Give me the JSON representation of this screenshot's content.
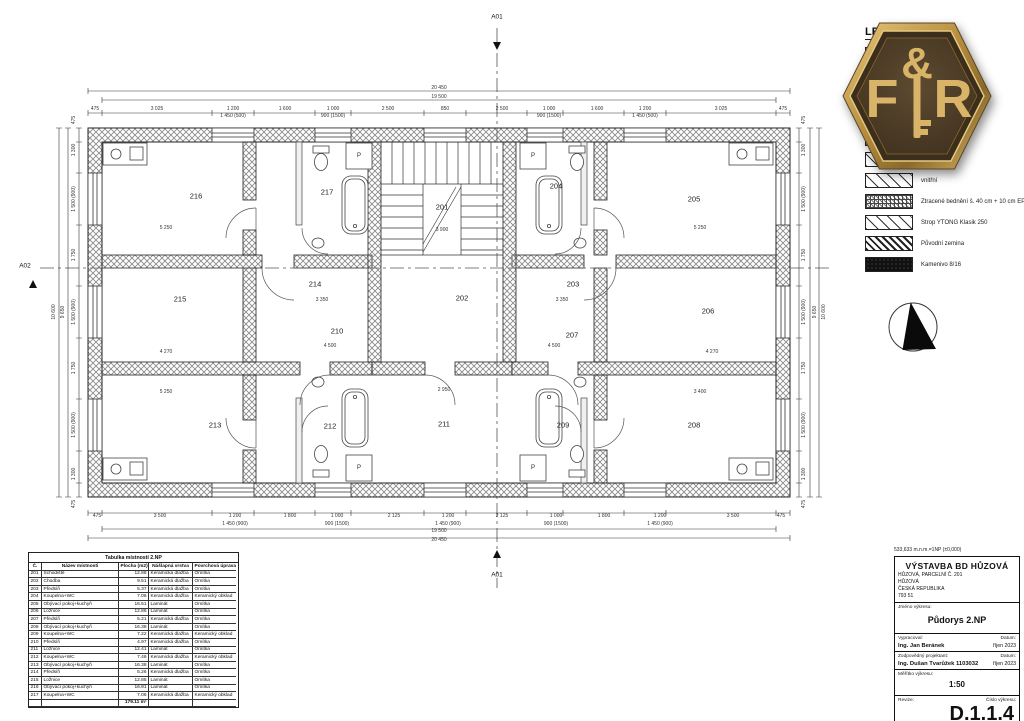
{
  "markers": {
    "a01_top": "A01",
    "a01_bottom": "A01",
    "a02": "A02"
  },
  "legend": {
    "title": "LEGENDA",
    "rows": [
      {
        "swatch": "checker",
        "label": "375 + 10 cm EPS"
      },
      {
        "swatch": "checker",
        "label": ""
      },
      {
        "swatch": "checker",
        "label": ""
      },
      {
        "swatch": "checker",
        "label": ""
      },
      {
        "swatch": "checker",
        "label": ""
      },
      {
        "swatch": "hatch-sparse",
        "label": ""
      },
      {
        "swatch": "hatch-sparse",
        "label": "vnitřní"
      },
      {
        "swatch": "grid",
        "label": "Ztracené bednění š. 40 cm + 10 cm EPS"
      },
      {
        "swatch": "hatch-sparse",
        "label": "Strop YTONG Klasik 250"
      },
      {
        "swatch": "hatch-dense",
        "label": "Původní zemina"
      },
      {
        "swatch": "dark",
        "label": "Kamenivo 8/16"
      }
    ]
  },
  "logo": {
    "left": "F",
    "amp": "&",
    "right": "R"
  },
  "plan": {
    "rooms": [
      {
        "n": "216",
        "x": 196,
        "y": 196
      },
      {
        "n": "217",
        "x": 327,
        "y": 192
      },
      {
        "n": "201",
        "x": 442,
        "y": 207
      },
      {
        "n": "204",
        "x": 556,
        "y": 186
      },
      {
        "n": "205",
        "x": 694,
        "y": 199
      },
      {
        "n": "215",
        "x": 180,
        "y": 299
      },
      {
        "n": "214",
        "x": 315,
        "y": 284
      },
      {
        "n": "202",
        "x": 462,
        "y": 298
      },
      {
        "n": "203",
        "x": 573,
        "y": 284
      },
      {
        "n": "206",
        "x": 708,
        "y": 311
      },
      {
        "n": "210",
        "x": 337,
        "y": 331
      },
      {
        "n": "207",
        "x": 572,
        "y": 335
      },
      {
        "n": "213",
        "x": 215,
        "y": 425
      },
      {
        "n": "212",
        "x": 330,
        "y": 426
      },
      {
        "n": "211",
        "x": 444,
        "y": 424
      },
      {
        "n": "209",
        "x": 563,
        "y": 425
      },
      {
        "n": "208",
        "x": 694,
        "y": 425
      }
    ],
    "fixture_labels": [
      {
        "t": "P",
        "x": 359,
        "y": 156
      },
      {
        "t": "P",
        "x": 533,
        "y": 156
      },
      {
        "t": "P",
        "x": 359,
        "y": 468
      },
      {
        "t": "P",
        "x": 533,
        "y": 468
      }
    ],
    "dims": [
      {
        "t": "20 450",
        "x": 439,
        "y": 88
      },
      {
        "t": "19 500",
        "x": 439,
        "y": 97
      },
      {
        "t": "475",
        "x": 95,
        "y": 109
      },
      {
        "t": "3 025",
        "x": 157,
        "y": 109
      },
      {
        "t": "1 200",
        "x": 233,
        "y": 109
      },
      {
        "t": "1 450 (500)",
        "x": 233,
        "y": 116
      },
      {
        "t": "1 600",
        "x": 285,
        "y": 109
      },
      {
        "t": "1 000",
        "x": 333,
        "y": 109
      },
      {
        "t": "900 (1500)",
        "x": 333,
        "y": 116
      },
      {
        "t": "2 500",
        "x": 388,
        "y": 109
      },
      {
        "t": "850",
        "x": 445,
        "y": 109
      },
      {
        "t": "2 500",
        "x": 502,
        "y": 109
      },
      {
        "t": "1 000",
        "x": 549,
        "y": 109
      },
      {
        "t": "900 (1500)",
        "x": 549,
        "y": 116
      },
      {
        "t": "1 600",
        "x": 597,
        "y": 109
      },
      {
        "t": "1 200",
        "x": 645,
        "y": 109
      },
      {
        "t": "1 450 (500)",
        "x": 645,
        "y": 116
      },
      {
        "t": "3 025",
        "x": 721,
        "y": 109
      },
      {
        "t": "475",
        "x": 783,
        "y": 109
      },
      {
        "t": "475",
        "x": 97,
        "y": 516
      },
      {
        "t": "3 500",
        "x": 160,
        "y": 516
      },
      {
        "t": "1 200",
        "x": 235,
        "y": 516
      },
      {
        "t": "1 450 (900)",
        "x": 235,
        "y": 524
      },
      {
        "t": "1 800",
        "x": 290,
        "y": 516
      },
      {
        "t": "1 000",
        "x": 337,
        "y": 516
      },
      {
        "t": "900 (1500)",
        "x": 337,
        "y": 524
      },
      {
        "t": "2 125",
        "x": 394,
        "y": 516
      },
      {
        "t": "1 200",
        "x": 448,
        "y": 516
      },
      {
        "t": "1 450 (900)",
        "x": 448,
        "y": 524
      },
      {
        "t": "2 125",
        "x": 502,
        "y": 516
      },
      {
        "t": "1 000",
        "x": 556,
        "y": 516
      },
      {
        "t": "900 (1500)",
        "x": 556,
        "y": 524
      },
      {
        "t": "1 800",
        "x": 604,
        "y": 516
      },
      {
        "t": "1 200",
        "x": 660,
        "y": 516
      },
      {
        "t": "1 450 (900)",
        "x": 660,
        "y": 524
      },
      {
        "t": "3 500",
        "x": 733,
        "y": 516
      },
      {
        "t": "475",
        "x": 781,
        "y": 516
      },
      {
        "t": "19 500",
        "x": 439,
        "y": 531
      },
      {
        "t": "20 450",
        "x": 439,
        "y": 540
      },
      {
        "t": "475",
        "x": 74,
        "y": 120,
        "c": "rot"
      },
      {
        "t": "1 300",
        "x": 74,
        "y": 150,
        "c": "rot"
      },
      {
        "t": "1 500 (900)",
        "x": 74,
        "y": 199,
        "c": "rot"
      },
      {
        "t": "1 750",
        "x": 74,
        "y": 255,
        "c": "rot"
      },
      {
        "t": "1 500 (900)",
        "x": 74,
        "y": 312,
        "c": "rot"
      },
      {
        "t": "1 750",
        "x": 74,
        "y": 368,
        "c": "rot"
      },
      {
        "t": "1 500 (900)",
        "x": 74,
        "y": 425,
        "c": "rot"
      },
      {
        "t": "1 300",
        "x": 74,
        "y": 474,
        "c": "rot"
      },
      {
        "t": "475",
        "x": 74,
        "y": 504,
        "c": "rot"
      },
      {
        "t": "9 650",
        "x": 63,
        "y": 312,
        "c": "rot"
      },
      {
        "t": "10 600",
        "x": 54,
        "y": 312,
        "c": "rot"
      },
      {
        "t": "475",
        "x": 804,
        "y": 120,
        "c": "rot"
      },
      {
        "t": "1 300",
        "x": 804,
        "y": 150,
        "c": "rot"
      },
      {
        "t": "1 500 (900)",
        "x": 804,
        "y": 199,
        "c": "rot"
      },
      {
        "t": "1 750",
        "x": 804,
        "y": 255,
        "c": "rot"
      },
      {
        "t": "1 500 (900)",
        "x": 804,
        "y": 312,
        "c": "rot"
      },
      {
        "t": "1 750",
        "x": 804,
        "y": 368,
        "c": "rot"
      },
      {
        "t": "1 500 (900)",
        "x": 804,
        "y": 425,
        "c": "rot"
      },
      {
        "t": "1 300",
        "x": 804,
        "y": 474,
        "c": "rot"
      },
      {
        "t": "475",
        "x": 804,
        "y": 504,
        "c": "rot"
      },
      {
        "t": "9 650",
        "x": 815,
        "y": 312,
        "c": "rot"
      },
      {
        "t": "10 600",
        "x": 824,
        "y": 312,
        "c": "rot"
      },
      {
        "t": "3 900",
        "x": 442,
        "y": 230
      },
      {
        "t": "3 350",
        "x": 322,
        "y": 300
      },
      {
        "t": "3 350",
        "x": 562,
        "y": 300
      },
      {
        "t": "4 500",
        "x": 330,
        "y": 346
      },
      {
        "t": "4 500",
        "x": 554,
        "y": 346
      },
      {
        "t": "2 950",
        "x": 444,
        "y": 390
      },
      {
        "t": "5 250",
        "x": 166,
        "y": 228
      },
      {
        "t": "5 250",
        "x": 700,
        "y": 228
      },
      {
        "t": "4 270",
        "x": 166,
        "y": 352
      },
      {
        "t": "4 270",
        "x": 712,
        "y": 352
      },
      {
        "t": "5 250",
        "x": 166,
        "y": 392
      },
      {
        "t": "3 400",
        "x": 700,
        "y": 392
      }
    ]
  },
  "room_table": {
    "title": "Tabulka místností 2.NP",
    "headers": [
      "Č.",
      "Název místnosti",
      "Plocha (m2)",
      "Nášlapná vrstva",
      "Povrchová úprava zdí"
    ],
    "rows": [
      {
        "c": "201",
        "n": "Schodiště",
        "p": "12.88",
        "v": "Keramická dlažba",
        "s": "Omítka"
      },
      {
        "c": "202",
        "n": "Chodba",
        "p": "9.51",
        "v": "Keramická dlažba",
        "s": "Omítka"
      },
      {
        "c": "203",
        "n": "Předsíň",
        "p": "5.37",
        "v": "Keramická dlažba",
        "s": "Omítka"
      },
      {
        "c": "204",
        "n": "Koupelna+WC",
        "p": "7.06",
        "v": "Keramická dlažba",
        "s": "Keramický obklad"
      },
      {
        "c": "205",
        "n": "Obývací pokoj+kuchyň",
        "p": "16.51",
        "v": "Laminát",
        "s": "Omítka"
      },
      {
        "c": "206",
        "n": "Ložnice",
        "p": "12.86",
        "v": "Laminát",
        "s": "Omítka"
      },
      {
        "c": "207",
        "n": "Předsíň",
        "p": "5.21",
        "v": "Keramická dlažba",
        "s": "Omítka"
      },
      {
        "c": "208",
        "n": "Obývací pokoj+kuchyň",
        "p": "16.38",
        "v": "Laminát",
        "s": "Omítka"
      },
      {
        "c": "209",
        "n": "Koupelna+WC",
        "p": "7.22",
        "v": "Keramická dlažba",
        "s": "Keramický obklad"
      },
      {
        "c": "210",
        "n": "Předsíň",
        "p": "4.97",
        "v": "Keramická dlažba",
        "s": "Omítka"
      },
      {
        "c": "211",
        "n": "Ložnice",
        "p": "12.41",
        "v": "Laminát",
        "s": "Omítka"
      },
      {
        "c": "212",
        "n": "Koupelna+WC",
        "p": "7.46",
        "v": "Keramická dlažba",
        "s": "Keramický obklad"
      },
      {
        "c": "213",
        "n": "Obývací pokoj+kuchyň",
        "p": "16.38",
        "v": "Laminát",
        "s": "Omítka"
      },
      {
        "c": "214",
        "n": "Předsíň",
        "p": "5.26",
        "v": "Keramická dlažba",
        "s": "Omítka"
      },
      {
        "c": "215",
        "n": "Ložnice",
        "p": "12.85",
        "v": "Laminát",
        "s": "Omítka"
      },
      {
        "c": "216",
        "n": "Obývací pokoj+kuchyň",
        "p": "16.91",
        "v": "Laminát",
        "s": "Omítka"
      },
      {
        "c": "217",
        "n": "Koupelna+WC",
        "p": "7.06",
        "v": "Keramická dlažba",
        "s": "Keramický obklad"
      }
    ],
    "total": "179.11 m²"
  },
  "title_block": {
    "note": "533,633 m.n.m.=1NP (±0,000)",
    "project": "VÝSTAVBA BD HŮZOVÁ",
    "addr1": "HŮZOVÁ, PARCELNÍ Č. 201",
    "addr2": "HŮZOVÁ",
    "addr3": "ČESKÁ REPUBLIKA",
    "addr4": "793 51",
    "name_label": "Jméno výkresu:",
    "drawing_name": "Půdorys 2.NP",
    "author_label": "Vypracoval:",
    "date_label": "Datum:",
    "author": "Ing. Jan Beránek",
    "date1": "říjen 2023",
    "resp_label": "Zodpovědný projektant:",
    "resp": "Ing. Dušan Tvarůžek 1103032",
    "date2": "říjen 2023",
    "scale_label": "Měřítko výkresu:",
    "scale": "1:50",
    "rev_label": "Revize:",
    "num_label": "Číslo výkresu:",
    "number": "D.1.1.4"
  }
}
